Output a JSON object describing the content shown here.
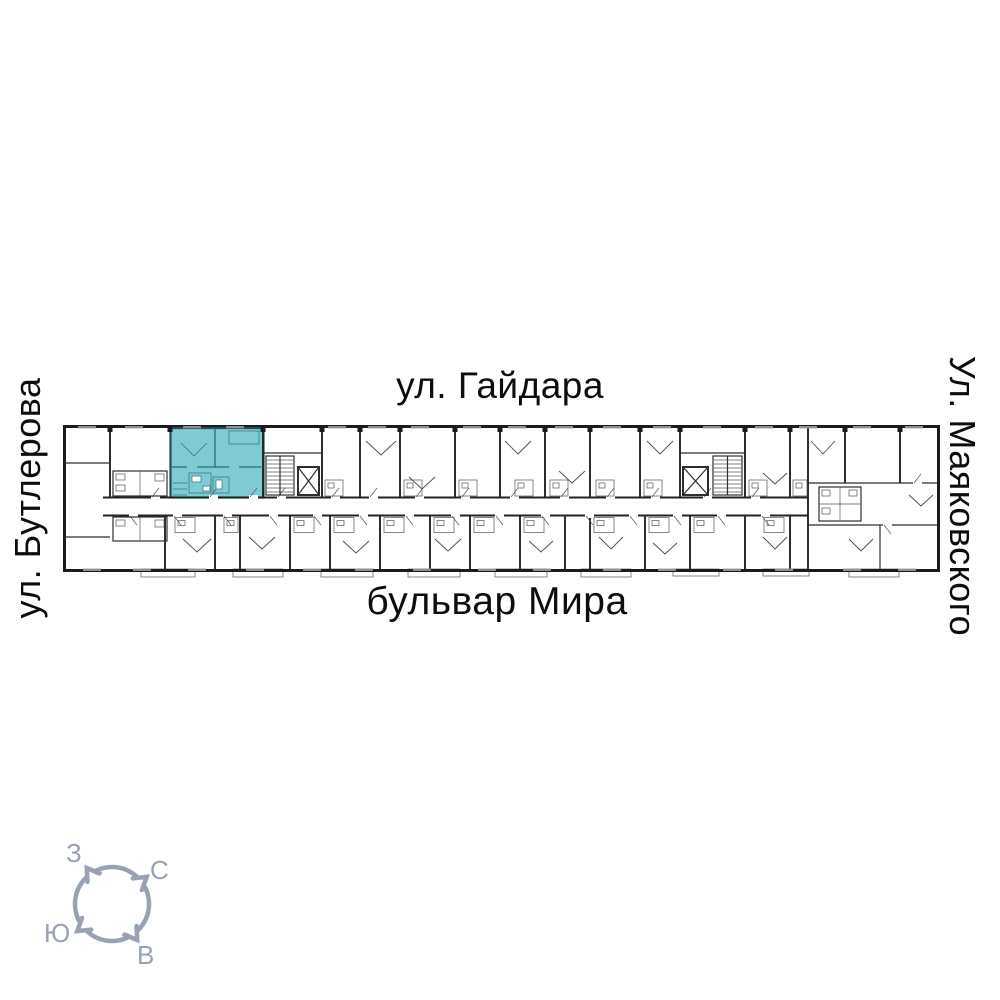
{
  "streets": {
    "top": "ул. Гайдара",
    "bottom": "бульвар Мира",
    "left": "ул. Бутлерова",
    "right": "Ул. Маяковского"
  },
  "compass": {
    "west": "З",
    "north": "С",
    "south": "Ю",
    "east": "В",
    "color": "#98a2b3"
  },
  "plan": {
    "highlight_color": "#7fcbd5",
    "wall_color": "#1b1b1b",
    "background": "#ffffff"
  }
}
